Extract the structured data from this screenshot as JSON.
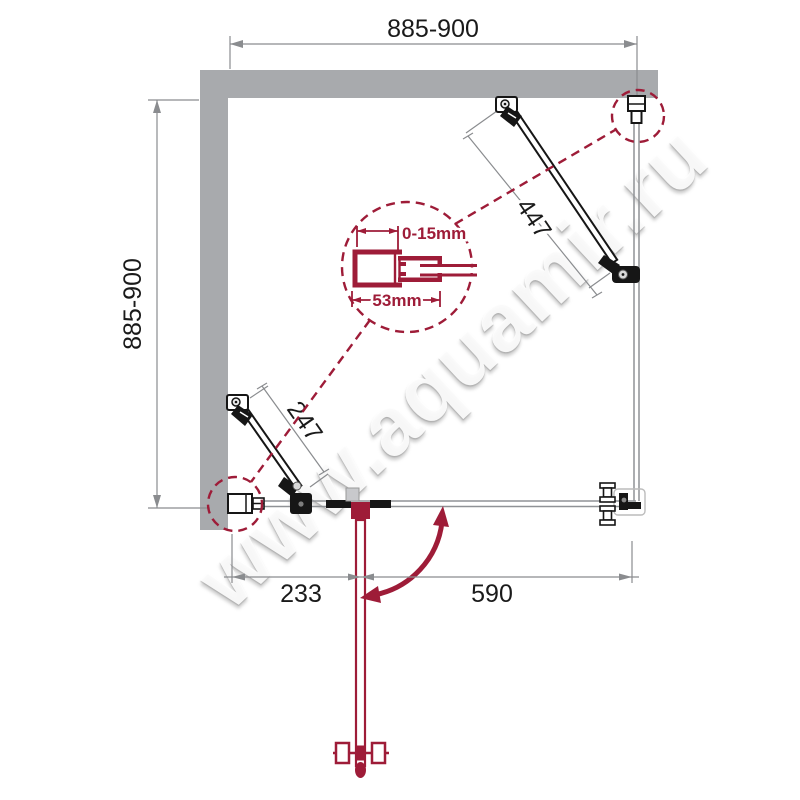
{
  "watermark": {
    "text": "www.aquamir.ru"
  },
  "colors": {
    "accent": "#9E1C38",
    "wall": "#A8AAAD",
    "glass": "#8F9296",
    "dim": "#8A8C8F",
    "ink": "#1A1A1A"
  },
  "dimensions": {
    "top_width": "885-900",
    "left_height": "885-900",
    "right_brace_length": "447",
    "left_brace_length": "247",
    "detail_adjustment_range": "0-15mm",
    "detail_profile_width": "53mm",
    "bottom_door_offset": "233",
    "bottom_opening_width": "590"
  }
}
